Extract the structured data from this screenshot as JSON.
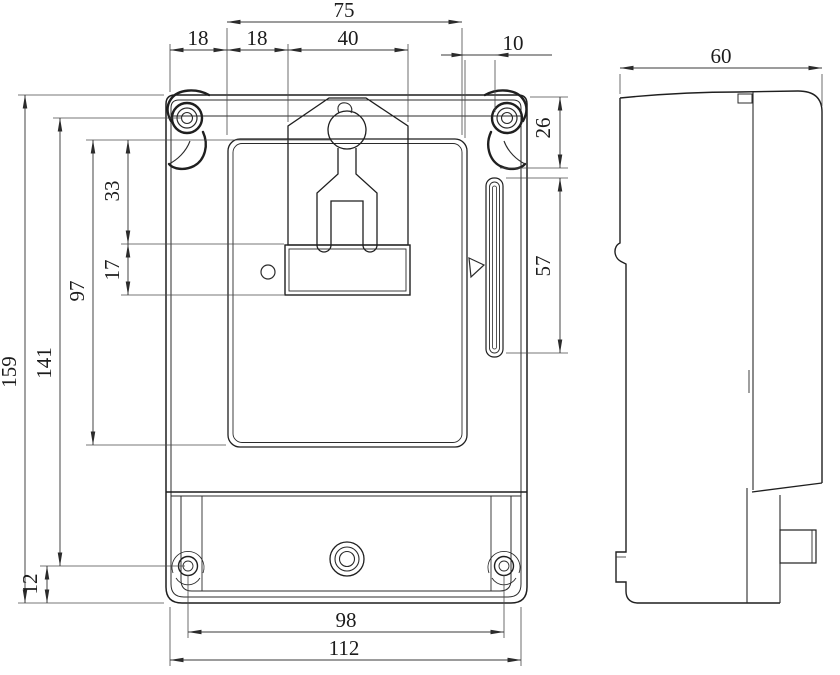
{
  "drawing": {
    "type": "technical-dimension-drawing",
    "subject": "energy-meter-enclosure",
    "background_color": "#ffffff",
    "line_color": "#1f1f1f",
    "dimension_color": "#3a3a3a",
    "dims": {
      "top_overall_width": "75",
      "edge_to_panel_offset": "18",
      "panel_to_bracket_offset": "18",
      "bracket_width": "40",
      "ear_width": "10",
      "overall_height": "159",
      "mount_screw_span_vertical": "141",
      "panel_height": "97",
      "panel_top_to_plate": "33",
      "plate_height": "17",
      "screw_to_bottom_edge": "12",
      "ear_height": "26",
      "side_rail_length": "57",
      "bottom_screw_span": "98",
      "bottom_overall_width": "112",
      "body_depth": "60"
    }
  }
}
